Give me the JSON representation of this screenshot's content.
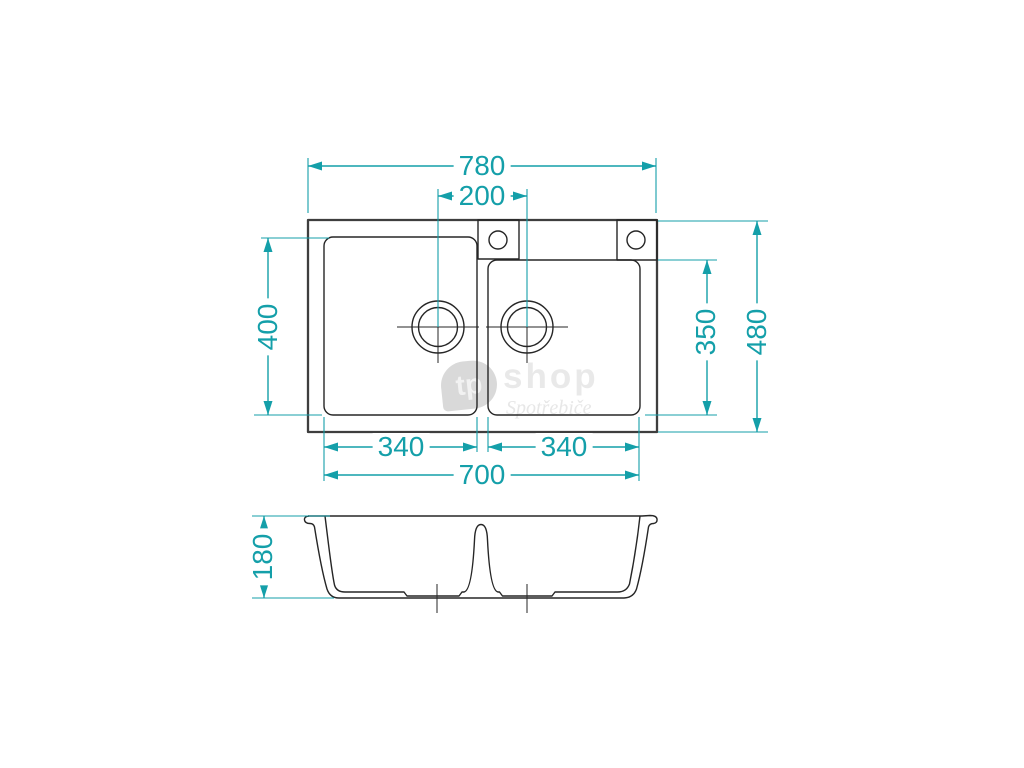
{
  "colors": {
    "dimension": "#149fa9",
    "line": "#262626",
    "watermark": "#d9d9d9"
  },
  "top_view": {
    "overall_width": "780",
    "drain_spacing": "200",
    "left_bowl_length": "400",
    "right_bowl_length": "350",
    "overall_depth": "480",
    "left_bowl_width": "340",
    "right_bowl_width": "340",
    "bowls_total_width": "700"
  },
  "side_view": {
    "bowl_depth": "180"
  },
  "watermark": {
    "logo": "tp",
    "brand": "shop",
    "tagline": "Spotřebiče"
  }
}
